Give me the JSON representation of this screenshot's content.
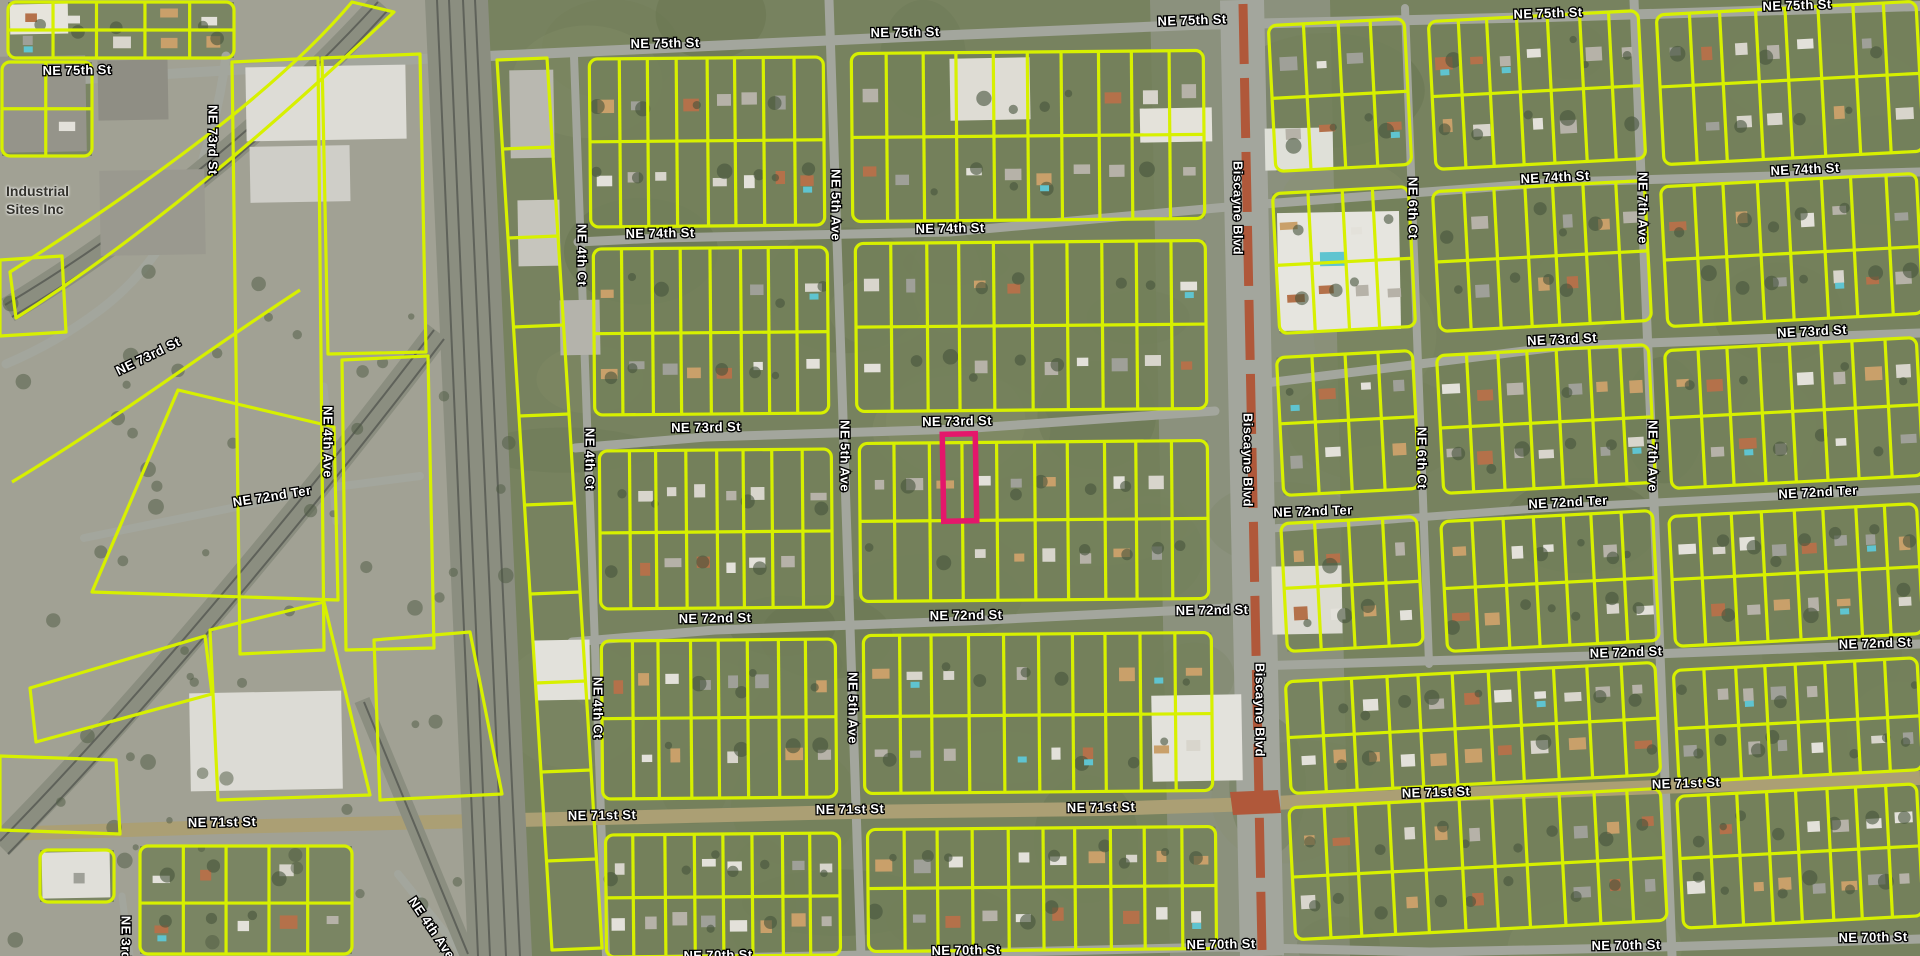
{
  "map": {
    "colors": {
      "base": "#77825f",
      "parcel_line": "#d7f000",
      "highlight": "#e4176b",
      "road": "#a3a69d",
      "major_road": "#ab9f74",
      "rail_bed": "#8b8e80",
      "rail_line": "#5f625a",
      "median": "#b0583a",
      "industrial_ground": "#a5a49a",
      "commercial_ground": "#9c9e96",
      "label_fill": "#ffffff",
      "label_stroke": "#000000"
    },
    "highlighted_parcel": {
      "x": 943,
      "y": 434,
      "width": 33,
      "height": 87,
      "color": "#e4176b"
    },
    "place_labels": [
      {
        "text": "Industrial",
        "x": 6,
        "y": 188
      },
      {
        "text": "Sites Inc",
        "x": 6,
        "y": 205
      }
    ],
    "street_labels": [
      {
        "t": "NE 75th St",
        "x": 77,
        "y": 70,
        "r": -1
      },
      {
        "t": "NE 75th St",
        "x": 665,
        "y": 43,
        "r": -1
      },
      {
        "t": "NE 75th St",
        "x": 905,
        "y": 32,
        "r": -1
      },
      {
        "t": "NE 75th St",
        "x": 1192,
        "y": 20,
        "r": -2
      },
      {
        "t": "NE 75th St",
        "x": 1548,
        "y": 13,
        "r": -2
      },
      {
        "t": "NE 75th St",
        "x": 1797,
        "y": 5,
        "r": -2
      },
      {
        "t": "NE 74th St",
        "x": 660,
        "y": 233,
        "r": -1
      },
      {
        "t": "NE 74th St",
        "x": 950,
        "y": 228,
        "r": -1
      },
      {
        "t": "NE 74th St",
        "x": 1555,
        "y": 177,
        "r": -3
      },
      {
        "t": "NE 74th St",
        "x": 1805,
        "y": 169,
        "r": -3
      },
      {
        "t": "NE 73rd St",
        "x": 213,
        "y": 140,
        "r": 90
      },
      {
        "t": "NE 73rd St",
        "x": 148,
        "y": 356,
        "r": -26
      },
      {
        "t": "NE 73rd St",
        "x": 706,
        "y": 427,
        "r": -1
      },
      {
        "t": "NE 73rd St",
        "x": 957,
        "y": 421,
        "r": -1
      },
      {
        "t": "NE 73rd St",
        "x": 1562,
        "y": 339,
        "r": -3
      },
      {
        "t": "NE 73rd St",
        "x": 1812,
        "y": 331,
        "r": -3
      },
      {
        "t": "NE 72nd Ter",
        "x": 272,
        "y": 496,
        "r": -9
      },
      {
        "t": "NE 72nd Ter",
        "x": 1313,
        "y": 511,
        "r": -2
      },
      {
        "t": "NE 72nd Ter",
        "x": 1568,
        "y": 502,
        "r": -3
      },
      {
        "t": "NE 72nd Ter",
        "x": 1818,
        "y": 492,
        "r": -3
      },
      {
        "t": "NE 72nd St",
        "x": 715,
        "y": 618,
        "r": -1
      },
      {
        "t": "NE 72nd St",
        "x": 966,
        "y": 615,
        "r": -1
      },
      {
        "t": "NE 72nd St",
        "x": 1212,
        "y": 610,
        "r": -1
      },
      {
        "t": "NE 72nd St",
        "x": 1626,
        "y": 652,
        "r": -2
      },
      {
        "t": "NE 72nd St",
        "x": 1875,
        "y": 643,
        "r": -2
      },
      {
        "t": "NE 71st St",
        "x": 222,
        "y": 822,
        "r": -1
      },
      {
        "t": "NE 71st St",
        "x": 602,
        "y": 815,
        "r": -1
      },
      {
        "t": "NE 71st St",
        "x": 850,
        "y": 809,
        "r": -1
      },
      {
        "t": "NE 71st St",
        "x": 1101,
        "y": 807,
        "r": -1
      },
      {
        "t": "NE 71st St",
        "x": 1436,
        "y": 792,
        "r": -2
      },
      {
        "t": "NE 71st St",
        "x": 1686,
        "y": 783,
        "r": -2
      },
      {
        "t": "NE 70th St",
        "x": 718,
        "y": 955,
        "r": -1
      },
      {
        "t": "NE 70th St",
        "x": 966,
        "y": 950,
        "r": -1
      },
      {
        "t": "NE 70th St",
        "x": 1221,
        "y": 944,
        "r": -1
      },
      {
        "t": "NE 70th St",
        "x": 1626,
        "y": 945,
        "r": -1
      },
      {
        "t": "NE 70th St",
        "x": 1873,
        "y": 937,
        "r": -1
      },
      {
        "t": "NE 4th Ct",
        "x": 582,
        "y": 255,
        "r": 90
      },
      {
        "t": "NE 4th Ct",
        "x": 590,
        "y": 459,
        "r": 90
      },
      {
        "t": "NE 4th Ct",
        "x": 598,
        "y": 708,
        "r": 90
      },
      {
        "t": "NE 5th Ave",
        "x": 836,
        "y": 205,
        "r": 90
      },
      {
        "t": "NE 5th Ave",
        "x": 845,
        "y": 456,
        "r": 90
      },
      {
        "t": "NE 5th Ave",
        "x": 853,
        "y": 708,
        "r": 90
      },
      {
        "t": "NE 6th Ct",
        "x": 1413,
        "y": 208,
        "r": 90
      },
      {
        "t": "NE 6th Ct",
        "x": 1422,
        "y": 458,
        "r": 90
      },
      {
        "t": "NE 7th Ave",
        "x": 1643,
        "y": 208,
        "r": 90
      },
      {
        "t": "NE 7th Ave",
        "x": 1653,
        "y": 456,
        "r": 90
      },
      {
        "t": "Biscayne Blvd",
        "x": 1238,
        "y": 208,
        "r": 90
      },
      {
        "t": "Biscayne Blvd",
        "x": 1248,
        "y": 460,
        "r": 90
      },
      {
        "t": "Biscayne Blvd",
        "x": 1260,
        "y": 710,
        "r": 90
      },
      {
        "t": "NE 4th Ave",
        "x": 328,
        "y": 442,
        "r": 90
      },
      {
        "t": "NE 4th Ave",
        "x": 432,
        "y": 928,
        "r": 56
      },
      {
        "t": "NE 3rd Ave",
        "x": 126,
        "y": 952,
        "r": 90
      }
    ],
    "features": {
      "roads": [
        {
          "d": "M0,84 L400,60 L665,48 L905,37 L1192,25 L1548,17 L1920,6",
          "w": 10
        },
        {
          "d": "M578,242 L660,238 L950,232 L1250,205 L1560,182 L1920,172",
          "w": 9
        },
        {
          "d": "M575,448 L706,437 L960,429 L1215,411",
          "w": 9
        },
        {
          "d": "M1250,385 L1565,346 L1920,333",
          "w": 9
        },
        {
          "d": "M226,56 C214,150 180,250 100,310 C60,340 25,356 6,364",
          "w": 9
        },
        {
          "d": "M84,538 L335,487 L420,476",
          "w": 8
        },
        {
          "d": "M1252,530 L1530,509 L1920,489",
          "w": 8
        },
        {
          "d": "M572,642 L715,630 L966,621 L1248,607",
          "w": 9
        },
        {
          "d": "M1252,666 L1626,655 L1920,644",
          "w": 9
        },
        {
          "d": "M578,962 L718,958 L966,953 L1225,947 L1430,952 L1626,948 L1920,939",
          "w": 9
        },
        {
          "d": "M574,56 L606,956",
          "w": 8
        },
        {
          "d": "M829,0 L861,956",
          "w": 9
        },
        {
          "d": "M1405,8 L1429,664",
          "w": 8
        },
        {
          "d": "M1634,0 L1672,956",
          "w": 9
        },
        {
          "d": "M324,386 L336,522",
          "w": 7
        },
        {
          "d": "M398,874 L464,956",
          "w": 8
        },
        {
          "d": "M122,896 L130,956",
          "w": 7
        }
      ],
      "major_road": {
        "d": "M0,834 L222,827 L602,818 L850,812 L1101,809 L1255,804 L1436,795 L1686,786 L1920,778",
        "w": 14
      },
      "biscayne": {
        "bed": "M1242,0 L1262,956",
        "bed_w": 44,
        "median": "M1243,4 L1262,950",
        "median_w": 9,
        "band": "M1230,792 L1278,790 L1281,813 L1233,815 Z"
      },
      "rails": {
        "main_bed": "425,0 488,0 532,956 468,956",
        "main_lines": [
          "M437,0 L478,956",
          "M449,0 L490,956",
          "M463,0 L506,956",
          "M475,0 L520,956"
        ],
        "curves": [
          {
            "bed": "M382,4 C290,105 165,215 8,310",
            "w": 26,
            "lines": [
              "M378,2 C286,103 161,212 5,305",
              "M388,10 C296,112 172,222 12,317"
            ]
          },
          {
            "bed": "M438,332 C335,468 155,690 0,846",
            "w": 26,
            "lines": [
              "M434,330 C331,466 151,687 0,841",
              "M444,339 C341,475 162,696 8,854"
            ]
          },
          {
            "bed": "M362,700 C402,798 436,880 468,956",
            "w": 16,
            "lines": [
              "M364,702 C404,800 438,882 468,954"
            ]
          }
        ]
      },
      "blocks": [
        {
          "x": 590,
          "y": 58,
          "w": 234,
          "h": 168,
          "cols": 8,
          "rot": -0.5
        },
        {
          "x": 852,
          "y": 52,
          "w": 352,
          "h": 168,
          "cols": 10,
          "rot": -0.5
        },
        {
          "x": 594,
          "y": 248,
          "w": 234,
          "h": 166,
          "cols": 8,
          "rot": -0.5
        },
        {
          "x": 856,
          "y": 242,
          "w": 350,
          "h": 168,
          "cols": 10,
          "rot": -0.5
        },
        {
          "x": 600,
          "y": 450,
          "w": 232,
          "h": 158,
          "cols": 8,
          "rot": -0.5
        },
        {
          "x": 860,
          "y": 442,
          "w": 348,
          "h": 158,
          "cols": 10,
          "rot": -0.5
        },
        {
          "x": 602,
          "y": 640,
          "w": 234,
          "h": 158,
          "cols": 8,
          "rot": -0.5
        },
        {
          "x": 864,
          "y": 634,
          "w": 348,
          "h": 158,
          "cols": 10,
          "rot": -0.5
        },
        {
          "x": 606,
          "y": 834,
          "w": 234,
          "h": 122,
          "cols": 8,
          "rot": -0.5
        },
        {
          "x": 868,
          "y": 828,
          "w": 348,
          "h": 122,
          "cols": 10,
          "rot": -0.5
        },
        {
          "x": 1272,
          "y": 22,
          "w": 136,
          "h": 146,
          "cols": 4,
          "rot": -3
        },
        {
          "x": 1432,
          "y": 16,
          "w": 210,
          "h": 148,
          "cols": 7,
          "rot": -3
        },
        {
          "x": 1660,
          "y": 8,
          "w": 260,
          "h": 150,
          "cols": 8,
          "rot": -3
        },
        {
          "x": 1276,
          "y": 190,
          "w": 136,
          "h": 140,
          "cols": 4,
          "rot": -3
        },
        {
          "x": 1436,
          "y": 186,
          "w": 212,
          "h": 140,
          "cols": 7,
          "rot": -3
        },
        {
          "x": 1664,
          "y": 180,
          "w": 256,
          "h": 140,
          "cols": 8,
          "rot": -3
        },
        {
          "x": 1280,
          "y": 354,
          "w": 136,
          "h": 138,
          "cols": 4,
          "rot": -3
        },
        {
          "x": 1440,
          "y": 350,
          "w": 212,
          "h": 138,
          "cols": 7,
          "rot": -3
        },
        {
          "x": 1668,
          "y": 344,
          "w": 252,
          "h": 138,
          "cols": 8,
          "rot": -3
        },
        {
          "x": 1284,
          "y": 520,
          "w": 136,
          "h": 128,
          "cols": 4,
          "rot": -3
        },
        {
          "x": 1444,
          "y": 516,
          "w": 212,
          "h": 130,
          "cols": 7,
          "rot": -3
        },
        {
          "x": 1672,
          "y": 510,
          "w": 248,
          "h": 130,
          "cols": 8,
          "rot": -3
        },
        {
          "x": 1288,
          "y": 672,
          "w": 370,
          "h": 112,
          "cols": 11,
          "rot": -3
        },
        {
          "x": 1676,
          "y": 664,
          "w": 244,
          "h": 112,
          "cols": 8,
          "rot": -3
        },
        {
          "x": 1292,
          "y": 798,
          "w": 372,
          "h": 132,
          "cols": 11,
          "rot": -3
        },
        {
          "x": 1680,
          "y": 790,
          "w": 240,
          "h": 132,
          "cols": 8,
          "rot": -3
        },
        {
          "x": 8,
          "y": 2,
          "w": 226,
          "h": 56,
          "cols": 5,
          "rot": 0
        },
        {
          "x": 2,
          "y": 62,
          "w": 90,
          "h": 94,
          "cols": 2,
          "rot": 0
        },
        {
          "x": 140,
          "y": 846,
          "w": 212,
          "h": 108,
          "cols": 5,
          "rot": 0
        },
        {
          "x": 40,
          "y": 850,
          "w": 74,
          "h": 52,
          "cols": 1,
          "rot": 0,
          "rows": 1
        }
      ],
      "strip": {
        "pts": [
          [
            497,
            60
          ],
          [
            547,
            58
          ],
          [
            602,
            948
          ],
          [
            552,
            950
          ]
        ],
        "div": 10
      },
      "polygons": [
        "M352,2 L394,12 C300,100 170,220 16,318 L10,272 C162,175 282,85 352,2 Z",
        "M232,62 L318,58 L324,650 L240,654 Z",
        "M322,58 L420,54 L426,352 L328,354 Z",
        "M342,360 L428,356 L434,648 L346,650 Z",
        "M92,592 L178,390 L334,427 L338,600 Z",
        "M30,688 L205,636 L212,694 L36,742 Z",
        "M210,630 L324,602 L370,795 L218,800 Z",
        "M374,640 L470,632 L502,794 L380,800 Z",
        "M0,756 L116,760 L120,834 L0,830 Z",
        "M0,260 L62,256 L66,332 L0,336 Z",
        "M300,290 C215,345 115,420 12,482"
      ],
      "buildings": [
        {
          "x": 10,
          "y": 4,
          "w": 58,
          "h": 30,
          "f": "#e6e4dc"
        },
        {
          "x": 0,
          "y": 56,
          "w": 86,
          "h": 96,
          "f": "#95948a"
        },
        {
          "x": 98,
          "y": 60,
          "w": 70,
          "h": 60,
          "f": "#8f8e84"
        },
        {
          "x": 100,
          "y": 170,
          "w": 105,
          "h": 85,
          "f": "#9a998f"
        },
        {
          "x": 246,
          "y": 66,
          "w": 160,
          "h": 74,
          "f": "#dddcd6"
        },
        {
          "x": 250,
          "y": 146,
          "w": 100,
          "h": 56,
          "f": "#cfcec8"
        },
        {
          "x": 510,
          "y": 70,
          "w": 44,
          "h": 88,
          "f": "#b9b8b0"
        },
        {
          "x": 518,
          "y": 200,
          "w": 42,
          "h": 66,
          "f": "#c6c5bd"
        },
        {
          "x": 560,
          "y": 300,
          "w": 40,
          "h": 55,
          "f": "#b4b3ab"
        },
        {
          "x": 535,
          "y": 640,
          "w": 55,
          "h": 60,
          "f": "#e2e1db"
        },
        {
          "x": 190,
          "y": 692,
          "w": 152,
          "h": 98,
          "f": "#dcdbd5"
        },
        {
          "x": 42,
          "y": 852,
          "w": 68,
          "h": 46,
          "f": "#e0dfd9"
        },
        {
          "x": 950,
          "y": 58,
          "w": 80,
          "h": 62,
          "f": "#dedcd4"
        },
        {
          "x": 1140,
          "y": 108,
          "w": 72,
          "h": 34,
          "f": "#e4e2da"
        },
        {
          "x": 1265,
          "y": 128,
          "w": 68,
          "h": 42,
          "f": "#dfe0d8"
        },
        {
          "x": 1278,
          "y": 212,
          "w": 122,
          "h": 118,
          "f": "#e6e5df"
        },
        {
          "x": 1320,
          "y": 252,
          "w": 26,
          "h": 14,
          "f": "#5fc4d0"
        },
        {
          "x": 1152,
          "y": 695,
          "w": 90,
          "h": 86,
          "f": "#e3e2dc"
        },
        {
          "x": 1272,
          "y": 566,
          "w": 70,
          "h": 68,
          "f": "#dcdbd3"
        }
      ],
      "ground": {
        "industrial_west": "0,0 470,0 515,956 0,956",
        "commercial_w": "1150,0 1242,0 1262,956 1170,956",
        "commercial_e": "1262,0 1330,0 1350,956 1282,956"
      }
    }
  }
}
